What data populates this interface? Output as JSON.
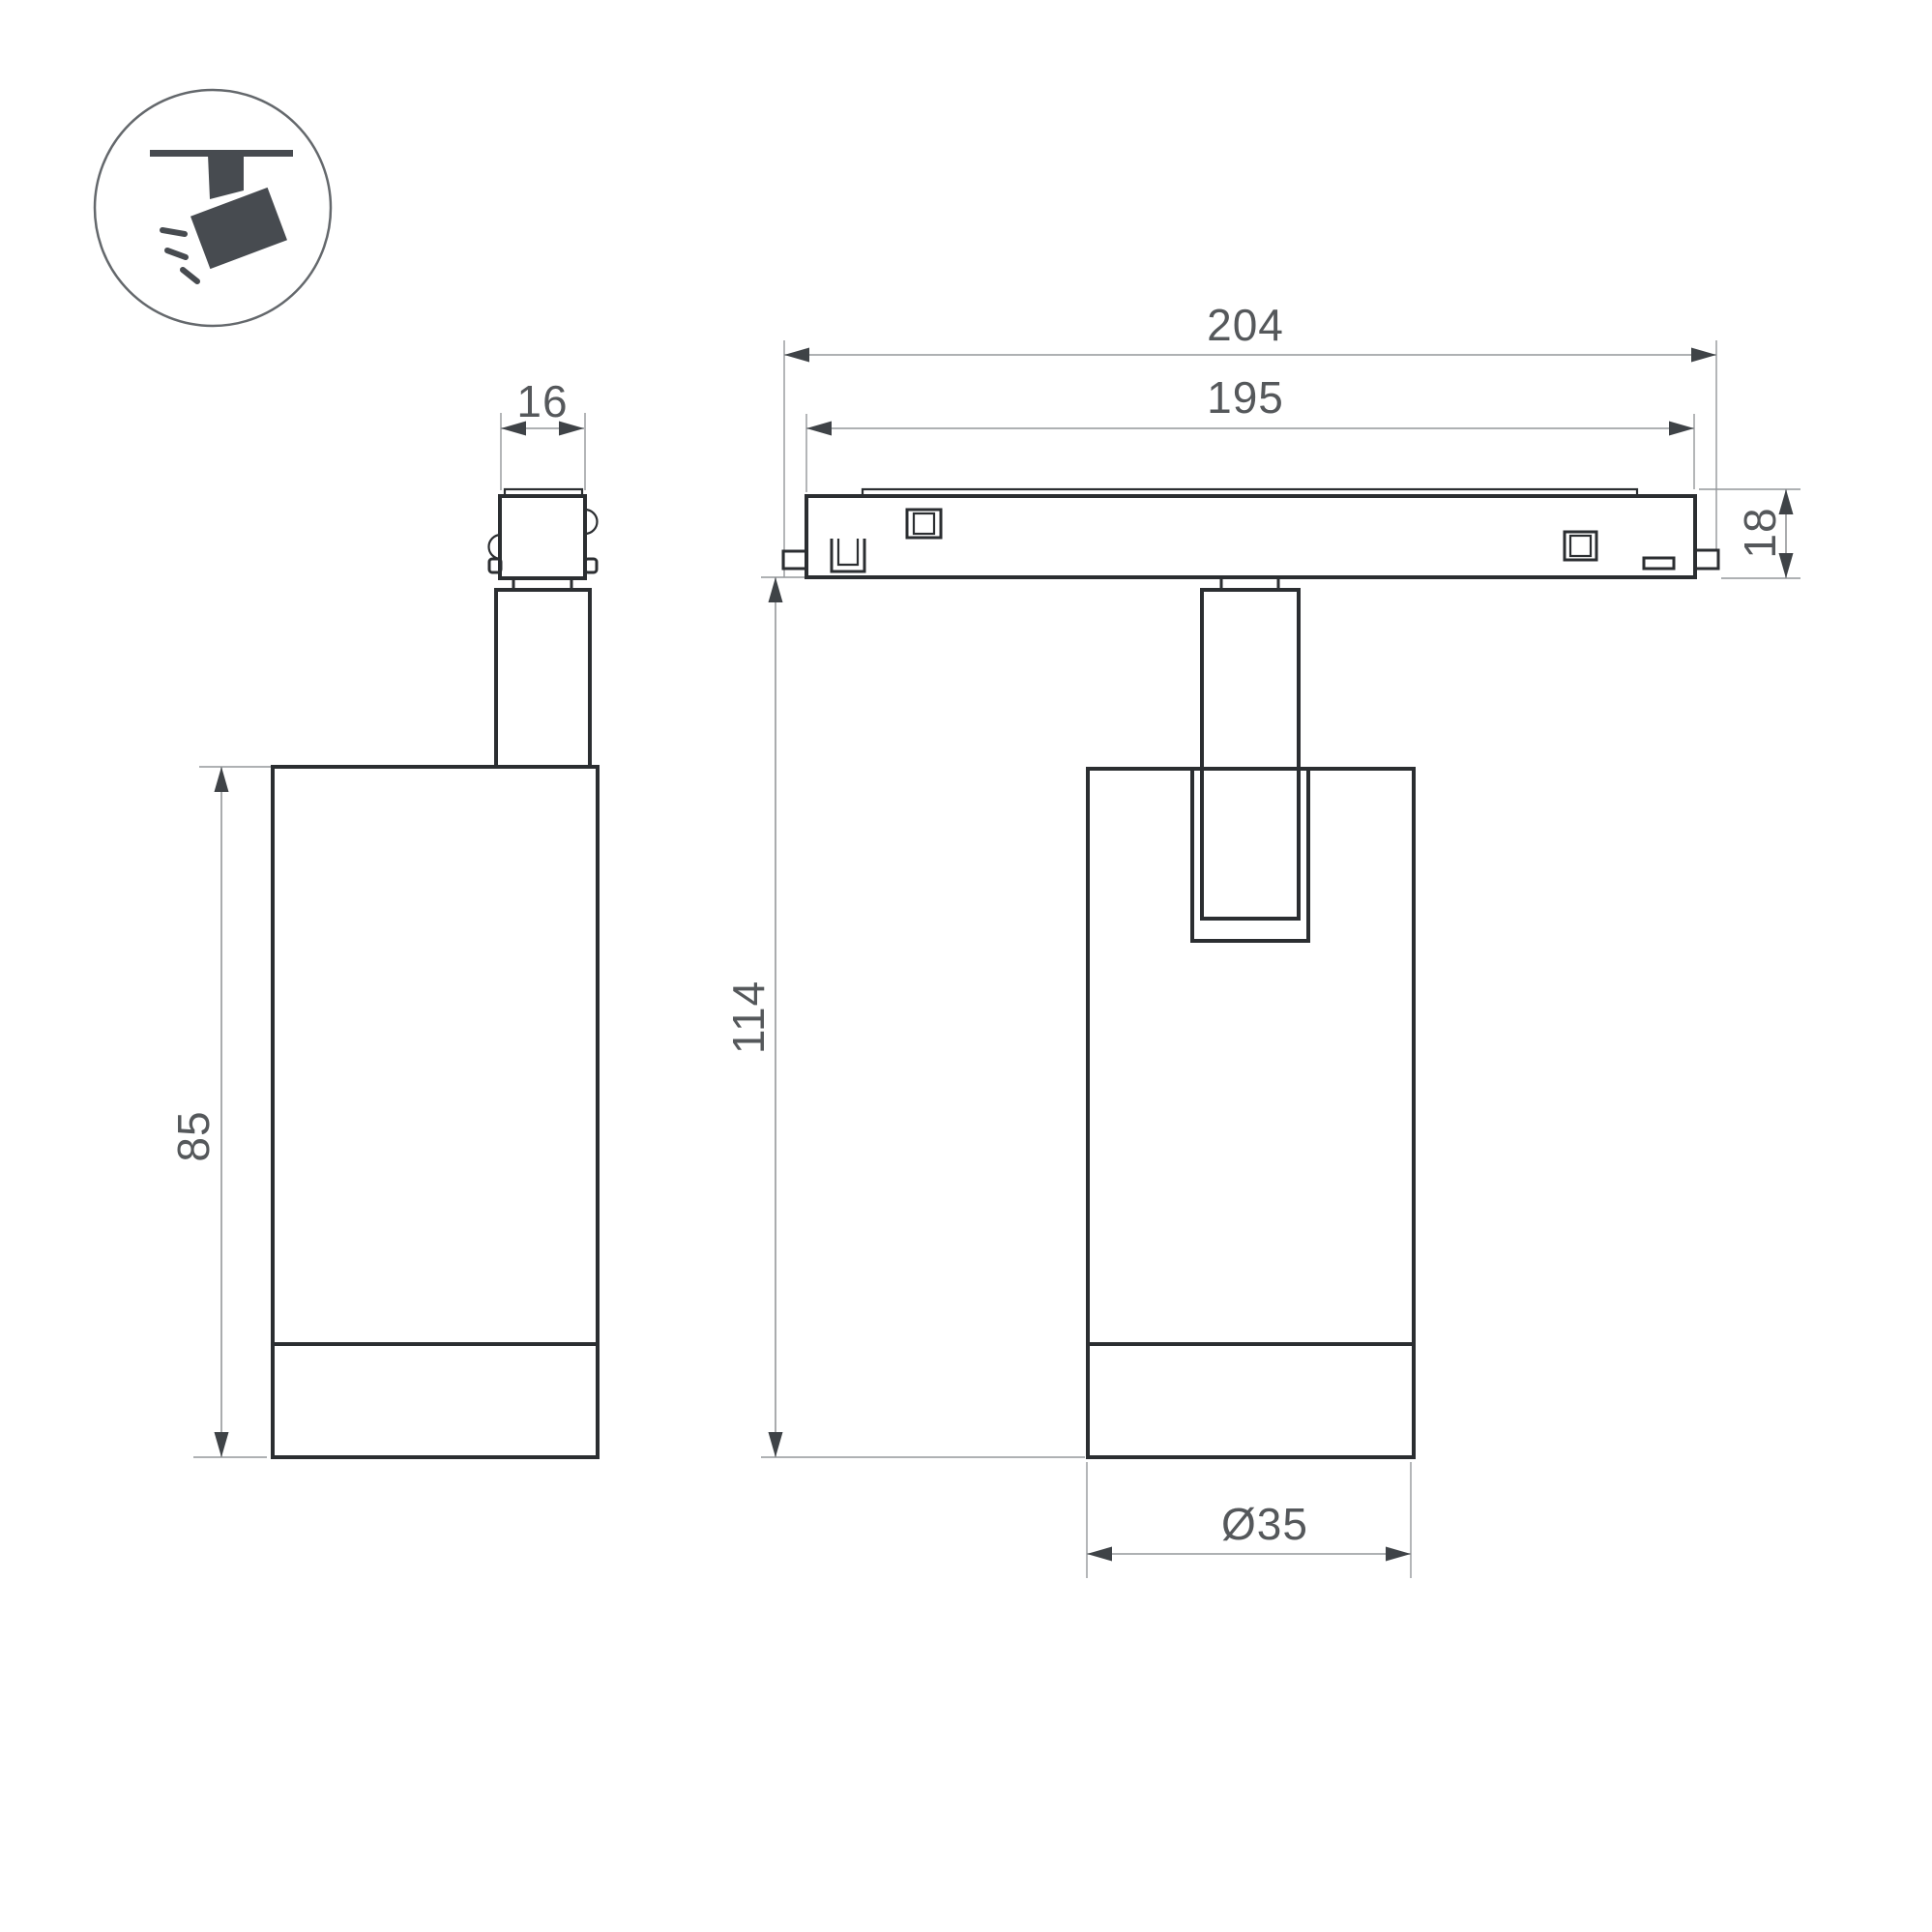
{
  "drawing": {
    "type": "technical-dimension-drawing",
    "subject": "magnetic track spotlight — side view, front view and ceiling icon"
  },
  "colors": {
    "outline": "#2b2e31",
    "dim": "#94979a",
    "arrow": "#3f4347",
    "text": "#55585b",
    "icon": "#474b50",
    "background": "#ffffff"
  },
  "icons": {
    "pictogram": "ceiling-track-spotlight-icon"
  },
  "dimensions": {
    "adapter_width": "16",
    "body_height": "85",
    "track_length_outer": "204",
    "track_length_inner": "195",
    "track_height": "18",
    "overall_height": "114",
    "body_diameter": "Ø35"
  }
}
